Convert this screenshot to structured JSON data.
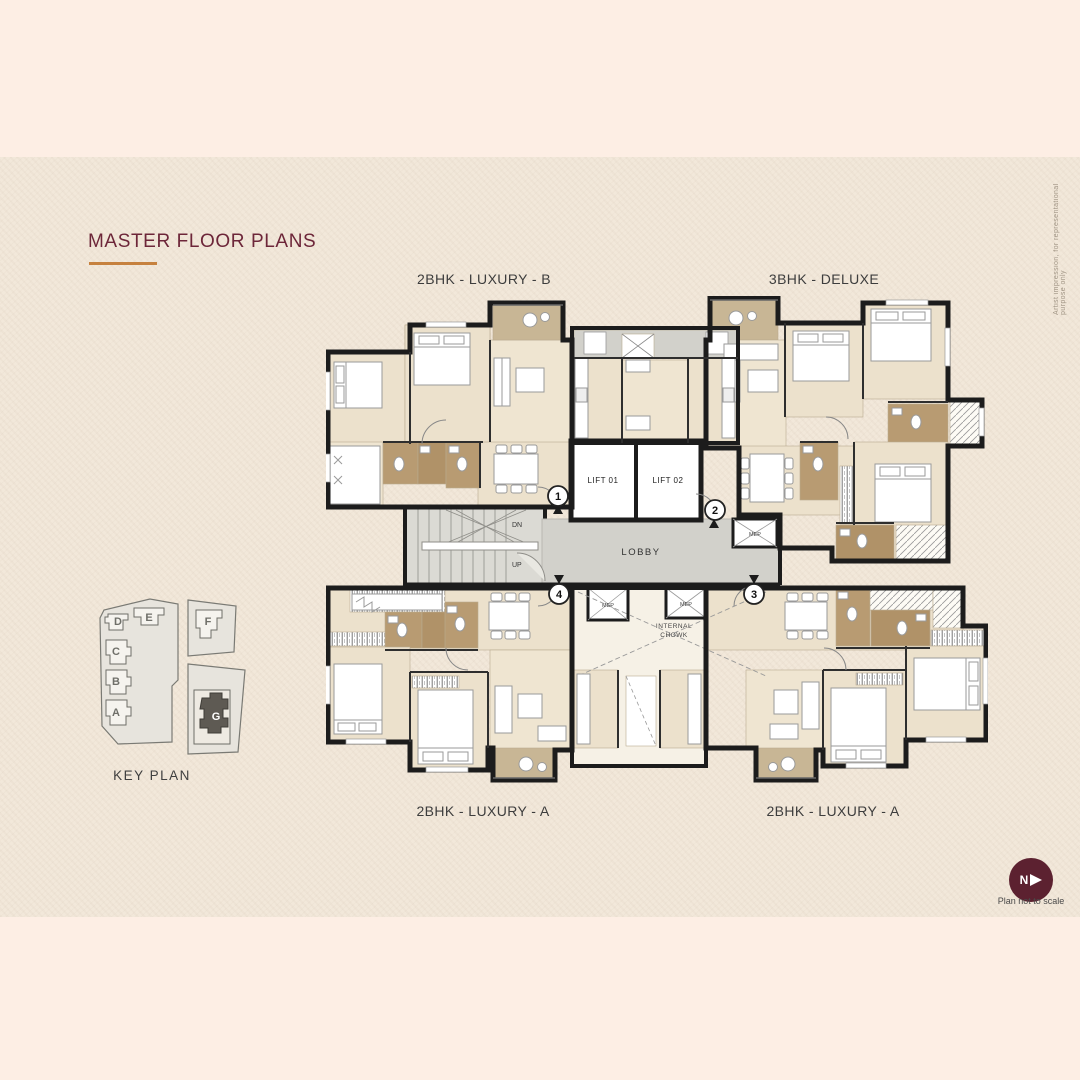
{
  "title": {
    "text": "MASTER FLOOR PLANS"
  },
  "disclaimer_side": "Artist impression, for representational purpose only",
  "units": {
    "top_left": "2BHK - LUXURY - B",
    "top_right": "3BHK - DELUXE",
    "bottom_left": "2BHK - LUXURY - A",
    "bottom_right": "2BHK - LUXURY - A"
  },
  "core": {
    "lift_01": "LIFT 01",
    "lift_02": "LIFT 02",
    "lobby": "LOBBY",
    "up": "UP",
    "dn": "DN",
    "mep": "MEP",
    "internal_chowk_line1": "INTERNAL",
    "internal_chowk_line2": "CHOWK",
    "entrance_1": "1",
    "entrance_2": "2",
    "entrance_3": "3",
    "entrance_4": "4"
  },
  "key_plan": {
    "caption": "KEY PLAN",
    "buildings": {
      "a": "A",
      "b": "B",
      "c": "C",
      "d": "D",
      "e": "E",
      "f": "F",
      "g": "G"
    },
    "highlighted_building": "G"
  },
  "north_indicator": {
    "letter": "N",
    "note": "Plan not to scale"
  },
  "colors": {
    "background": "#fdeee4",
    "band": "#f2e8da",
    "title": "#6d2639",
    "accent_underline": "#c6813e",
    "wall": "#1c1c1c",
    "floor": "#ece1cc",
    "bathroom": "#b89b72",
    "balcony": "#c8b695",
    "lobby": "#d2d1cb",
    "north_badge": "#5c2130"
  }
}
